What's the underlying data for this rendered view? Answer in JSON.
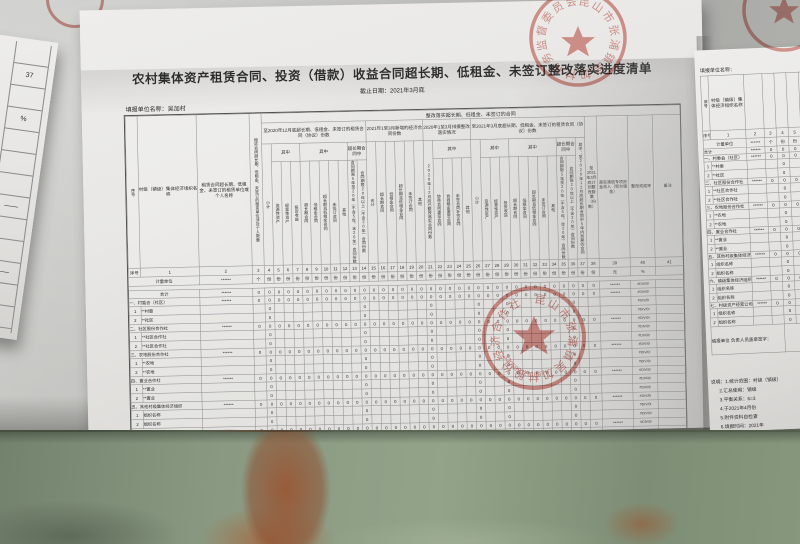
{
  "title": "农村集体资产租赁合同、投资（借款）收益合同超长期、低租金、未签订整改落实进度清单",
  "date_line": "截止日期：2021年3月底",
  "unit_line": {
    "label": "填报单位名称：",
    "value": "吴加村"
  },
  "table": {
    "banner": "整改落实超长期、低租金、未签订的合同",
    "left_headers": [
      "序号",
      "村级（镇级）集体经济组织名称",
      "租赁合同超长期、低租金、未签订的租赁单位或个人名称",
      "租赁合同超长期、低租金、未签订的租赁单位涉及个人数量"
    ],
    "groups": [
      {
        "label": "至2020年12月底超长期、低租金、未签订的租赁合同（协议）份数",
        "cols": 11
      },
      {
        "label": "2021年1至3月新增的经济合同份数",
        "cols": 6
      },
      {
        "label": "2020年1至3月排摸整改落实情况",
        "cols": 5
      },
      {
        "label": "至2021年3月底超长期、低租金、未签订的租赁合同（协议）份数",
        "cols": 12
      }
    ],
    "tail_headers": [
      "至2021年3月底计划整改数量（份数）",
      "落实清退专项资金收入（积欠租金）",
      "整改完成率",
      "备注"
    ],
    "subheaders": [
      {
        "t": "小计"
      },
      {
        "t": "其中",
        "leaves": [
          "资源性资产",
          "经营性资产",
          "投资收益"
        ]
      },
      {
        "t": "其中",
        "leaves": [
          "超长期合同",
          "低租金合同",
          "超长期且低租金合同",
          "未签订合同",
          "其他"
        ]
      },
      {
        "t": "超长期合同中",
        "leaves": [
          "合同期限5年至20年（不含5年，含20年）合同份数",
          "合同期限20年以上（不含20年）合同份数"
        ]
      },
      {
        "t": "合计"
      },
      {
        "t": "超长期合同"
      },
      {
        "t": "低租金合同"
      },
      {
        "t": "超长期且低租金合同"
      },
      {
        "t": "未签订合同"
      },
      {
        "t": "其他"
      },
      {
        "t": "2020年12月底已整改落实合同份数"
      },
      {
        "t": "其中",
        "leaves": [
          "协商合同重签合同",
          "协商租金重签合同",
          "未签合同补签合同",
          "其他"
        ]
      },
      {
        "t": "小计"
      },
      {
        "t": "其中",
        "leaves": [
          "资源性资产",
          "经营性资产",
          "投资收益"
        ]
      },
      {
        "t": "其中",
        "leaves": [
          "超长期合同",
          "低租金合同",
          "超长期且低租金合同",
          "未签订合同",
          "其他"
        ]
      },
      {
        "t": "超长期合同中",
        "leaves": [
          "合同期限5年至20年（不含5年，含20年）合同份数",
          "合同期限20年以上（不含20年）合同份数"
        ]
      },
      {
        "t": "其中：至2020年12月底超长期合同中5年内到期的合同"
      }
    ],
    "seq_label": "序号",
    "unit_row_label": "计量单位",
    "units": {
      "name_col": "******",
      "count_col": "个",
      "default": "份",
      "col39": "元",
      "col40": "%",
      "col41": ""
    },
    "values": {
      "zero": "0",
      "overflow": "******",
      "div0": "#DIV/0!",
      "sub_zero_cols": [
        4,
        14,
        21,
        26,
        29,
        36
      ]
    },
    "rows": [
      {
        "type": "total",
        "label": "合计"
      },
      {
        "type": "cat",
        "label": "一、村委会（社区）"
      },
      {
        "type": "sub",
        "no": "1",
        "label": "**村委"
      },
      {
        "type": "sub",
        "no": "2",
        "label": "**社区"
      },
      {
        "type": "cat",
        "label": "二、社区股份合作社"
      },
      {
        "type": "sub",
        "no": "1",
        "label": "**社区合作社"
      },
      {
        "type": "sub",
        "no": "2",
        "label": "**社区合作社"
      },
      {
        "type": "cat",
        "label": "三、农地股份合作社"
      },
      {
        "type": "sub",
        "no": "1",
        "label": "**农地"
      },
      {
        "type": "sub",
        "no": "2",
        "label": "**农地"
      },
      {
        "type": "cat",
        "label": "四、置业合作社"
      },
      {
        "type": "sub",
        "no": "1",
        "label": "**置业"
      },
      {
        "type": "sub",
        "no": "2",
        "label": "**置业"
      },
      {
        "type": "cat",
        "label": "五、其他村级集体经济组织"
      },
      {
        "type": "sub",
        "no": "1",
        "label": "组织名称"
      },
      {
        "type": "sub",
        "no": "2",
        "label": "组织名称"
      },
      {
        "type": "cat",
        "label": "六、镇级集体经济组织"
      },
      {
        "type": "sub",
        "no": "1",
        "label": "组织名称"
      },
      {
        "type": "sub",
        "no": "2",
        "label": "组织名称"
      },
      {
        "type": "cat",
        "label": "七、村级资产经营公司"
      },
      {
        "type": "sub",
        "no": "1",
        "label": "组织名称"
      },
      {
        "type": "sub",
        "no": "2",
        "label": "组织名称"
      }
    ]
  },
  "footer": {
    "cells": [
      {
        "line1": "填报单位",
        "line2": "负责人员盖章签字："
      },
      {
        "line1": "填报人员",
        "line2": "签字："
      },
      {
        "line1": "区镇农经办",
        "line2": "核对审核盖章："
      }
    ],
    "date_label": "年　月",
    "note_label": "备注"
  },
  "stamps": {
    "top": {
      "ring_text": "昆山市张浦镇吴加村村务监督委员会"
    },
    "bottom": {
      "ring_text": "昆山市张浦镇吴加村股份经济合作社",
      "number": "3205830211897"
    }
  },
  "right_sheet": {
    "unit_line": "填报单位名称：",
    "notes": [
      "说明：1.统计范围：村级（镇级）",
      "2.汇总使用：镇级",
      "3.平衡关系：6=3",
      "4.于2021年4月份",
      "5.附件资料自检查",
      "6.填报时间：2021年"
    ]
  },
  "left_sheet": {
    "cells": [
      "",
      "37",
      "",
      "%",
      "",
      "",
      "",
      "——",
      "",
      "",
      "——",
      "",
      ""
    ]
  }
}
